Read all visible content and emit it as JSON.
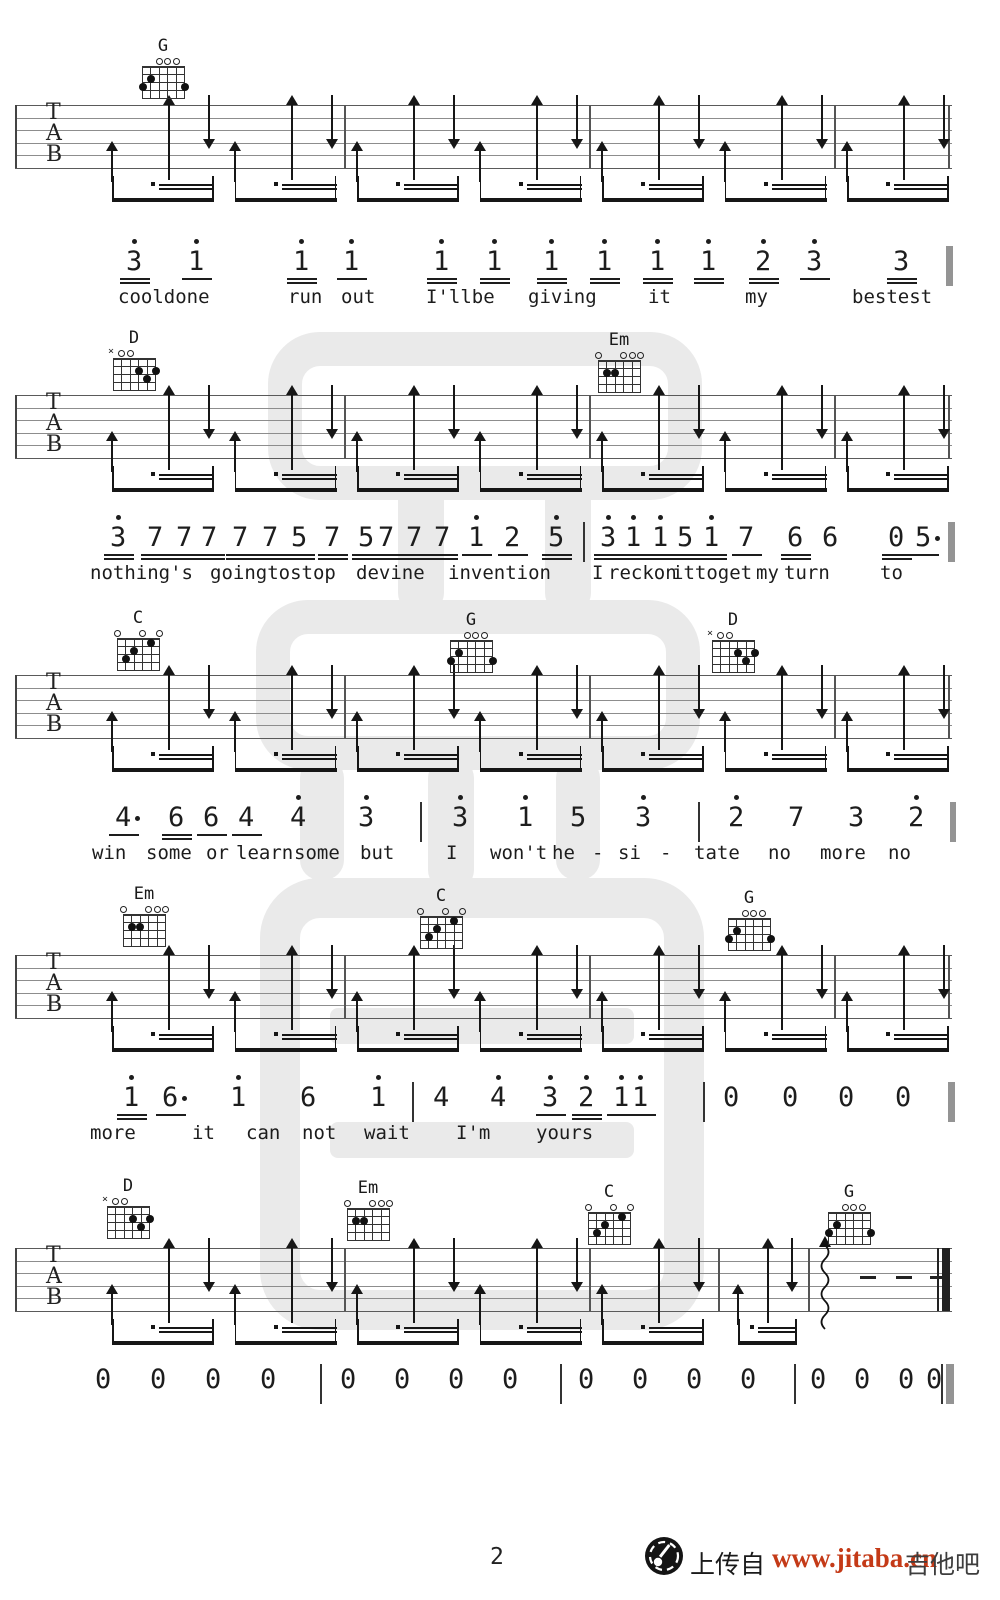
{
  "page": {
    "width": 1000,
    "height": 1600
  },
  "footer": {
    "page_number": "2",
    "upload_label": "上传自",
    "site_url": "www.jitaba.cn",
    "site_name": "吉他吧",
    "url_color": "#c43a17",
    "logo_icon": "guitar-site-logo-icon"
  },
  "ink_color": "#1d1d1d",
  "watermark_color": "#d9d9d9",
  "tab_letters": [
    "T",
    "A",
    "B"
  ],
  "chord_shapes": {
    "G": {
      "markers": [
        "",
        "",
        "o",
        "o",
        "o",
        ""
      ],
      "dots": [
        [
          0,
          3
        ],
        [
          1,
          2
        ],
        [
          5,
          3
        ]
      ]
    },
    "D": {
      "markers": [
        "x",
        "o",
        "o",
        "",
        "",
        ""
      ],
      "dots": [
        [
          3,
          2
        ],
        [
          4,
          3
        ],
        [
          5,
          2
        ]
      ]
    },
    "Em": {
      "markers": [
        "o",
        "",
        "",
        "o",
        "o",
        "o"
      ],
      "dots": [
        [
          1,
          2
        ],
        [
          2,
          2
        ]
      ]
    },
    "C": {
      "markers": [
        "o",
        "",
        "",
        "o",
        "",
        "o"
      ],
      "dots": [
        [
          1,
          3
        ],
        [
          2,
          2
        ],
        [
          4,
          1
        ]
      ]
    }
  },
  "systems": [
    {
      "staffTop": 105,
      "bars": [
        344,
        589,
        834
      ],
      "chords": [
        {
          "name": "G",
          "x": 142,
          "y": 38
        }
      ]
    },
    {
      "staffTop": 395,
      "bars": [
        344,
        589,
        834
      ],
      "chords": [
        {
          "name": "D",
          "x": 113,
          "y": 330
        },
        {
          "name": "Em",
          "x": 598,
          "y": 332
        }
      ]
    },
    {
      "staffTop": 675,
      "bars": [
        344,
        589,
        834
      ],
      "chords": [
        {
          "name": "C",
          "x": 117,
          "y": 610
        },
        {
          "name": "G",
          "x": 450,
          "y": 612
        },
        {
          "name": "D",
          "x": 712,
          "y": 612
        }
      ]
    },
    {
      "staffTop": 955,
      "bars": [
        344,
        589,
        834
      ],
      "chords": [
        {
          "name": "Em",
          "x": 123,
          "y": 886
        },
        {
          "name": "C",
          "x": 420,
          "y": 888
        },
        {
          "name": "G",
          "x": 728,
          "y": 890
        }
      ]
    },
    {
      "staffTop": 1248,
      "bars": [
        344,
        589,
        718
      ],
      "final": true,
      "chords": [
        {
          "name": "D",
          "x": 107,
          "y": 1178
        },
        {
          "name": "Em",
          "x": 347,
          "y": 1180
        },
        {
          "name": "C",
          "x": 588,
          "y": 1184
        },
        {
          "name": "G",
          "x": 828,
          "y": 1184
        }
      ]
    }
  ],
  "number_lines": [
    {
      "y": 248,
      "lyrics_y": 288,
      "tokens": [
        {
          "t": "3",
          "x": 126,
          "h": 1,
          "u": 2
        },
        {
          "t": "1",
          "x": 188,
          "h": 1,
          "u": 1
        },
        {
          "t": "1",
          "x": 293,
          "h": 1,
          "u": 2
        },
        {
          "t": "1",
          "x": 343,
          "h": 1,
          "u": 1
        },
        {
          "t": "1",
          "x": 433,
          "h": 1,
          "u": 2
        },
        {
          "t": "1",
          "x": 486,
          "h": 1,
          "u": 2
        },
        {
          "t": "1",
          "x": 543,
          "h": 1,
          "u": 2
        },
        {
          "t": "1",
          "x": 596,
          "h": 1,
          "u": 2
        },
        {
          "t": "1",
          "x": 649,
          "h": 1,
          "u": 2
        },
        {
          "t": "1",
          "x": 700,
          "h": 1,
          "u": 2
        },
        {
          "t": "2",
          "x": 755,
          "h": 1,
          "u": 2
        },
        {
          "t": "3",
          "x": 806,
          "h": 1,
          "u": 1
        },
        {
          "t": "3",
          "x": 893,
          "u": 2
        },
        {
          "bar": 1,
          "x": 946,
          "w": 7
        }
      ],
      "lyrics": [
        {
          "w": "cooldone",
          "x": 118
        },
        {
          "w": "run",
          "x": 288
        },
        {
          "w": "out",
          "x": 341
        },
        {
          "w": "I'llbe",
          "x": 426
        },
        {
          "w": "giving",
          "x": 528
        },
        {
          "w": "it",
          "x": 648
        },
        {
          "w": "my",
          "x": 745
        },
        {
          "w": "bestest",
          "x": 852
        }
      ]
    },
    {
      "y": 524,
      "lyrics_y": 564,
      "tokens": [
        {
          "t": "3",
          "x": 110,
          "h": 1,
          "u": 2
        },
        {
          "t": "7",
          "x": 147,
          "u": 2
        },
        {
          "t": "7",
          "x": 176,
          "u": 2
        },
        {
          "t": "7",
          "x": 201,
          "u": 2
        },
        {
          "t": "7",
          "x": 232,
          "u": 2
        },
        {
          "t": "7",
          "x": 262,
          "u": 2
        },
        {
          "t": "5",
          "x": 291,
          "u": 2
        },
        {
          "t": "7",
          "x": 324,
          "u": 2
        },
        {
          "t": "5",
          "x": 358,
          "u": 2
        },
        {
          "t": "7",
          "x": 378,
          "u": 2
        },
        {
          "t": "7",
          "x": 406,
          "u": 2
        },
        {
          "t": "7",
          "x": 434,
          "u": 2
        },
        {
          "t": "1",
          "x": 468,
          "h": 1,
          "u": 1
        },
        {
          "t": "2",
          "x": 504,
          "u": 1
        },
        {
          "t": "5",
          "x": 548,
          "h": 1,
          "u": 2
        },
        {
          "bar": 1,
          "x": 583
        },
        {
          "t": "3",
          "x": 600,
          "h": 1,
          "u": 2
        },
        {
          "t": "1",
          "x": 625,
          "h": 1,
          "u": 2
        },
        {
          "t": "1",
          "x": 652,
          "h": 1,
          "u": 2
        },
        {
          "t": "5",
          "x": 677,
          "u": 2
        },
        {
          "t": "1",
          "x": 703,
          "h": 1,
          "u": 2
        },
        {
          "t": "7",
          "x": 738,
          "u": 1
        },
        {
          "t": "6",
          "x": 787,
          "u": 2
        },
        {
          "t": "6",
          "x": 822
        },
        {
          "t": "0",
          "x": 888,
          "u": 2
        },
        {
          "t": "5",
          "x": 915,
          "da": 1,
          "u": 1
        },
        {
          "bar": 1,
          "x": 948,
          "w": 7
        }
      ],
      "lyrics": [
        {
          "w": "nothing's",
          "x": 90
        },
        {
          "w": "goingtostop",
          "x": 210
        },
        {
          "w": "devine",
          "x": 356
        },
        {
          "w": "invention",
          "x": 448
        },
        {
          "w": "I",
          "x": 592
        },
        {
          "w": "reckon",
          "x": 608
        },
        {
          "w": "ittoget",
          "x": 672
        },
        {
          "w": "my",
          "x": 756
        },
        {
          "w": "turn",
          "x": 784
        },
        {
          "w": "to",
          "x": 880
        }
      ]
    },
    {
      "y": 804,
      "lyrics_y": 844,
      "tokens": [
        {
          "t": "4",
          "x": 115,
          "da": 1,
          "u": 1
        },
        {
          "t": "6",
          "x": 168,
          "u": 2
        },
        {
          "t": "6",
          "x": 203,
          "u": 1
        },
        {
          "t": "4",
          "x": 238,
          "u": 1
        },
        {
          "t": "4",
          "x": 290,
          "h": 1
        },
        {
          "t": "3",
          "x": 358,
          "h": 1
        },
        {
          "bar": 1,
          "x": 420
        },
        {
          "t": "3",
          "x": 452,
          "h": 1
        },
        {
          "t": "1",
          "x": 517,
          "h": 1
        },
        {
          "t": "5",
          "x": 570
        },
        {
          "t": "3",
          "x": 635,
          "h": 1
        },
        {
          "bar": 1,
          "x": 698
        },
        {
          "t": "2",
          "x": 728,
          "h": 1
        },
        {
          "t": "7",
          "x": 788
        },
        {
          "t": "3",
          "x": 848
        },
        {
          "t": "2",
          "x": 908,
          "h": 1
        },
        {
          "bar": 1,
          "x": 950,
          "w": 6
        }
      ],
      "lyrics": [
        {
          "w": "win",
          "x": 92
        },
        {
          "w": "some",
          "x": 146
        },
        {
          "w": "or",
          "x": 206
        },
        {
          "w": "learn",
          "x": 236
        },
        {
          "w": "some",
          "x": 294
        },
        {
          "w": "but",
          "x": 360
        },
        {
          "w": "I",
          "x": 446
        },
        {
          "w": "won't",
          "x": 490
        },
        {
          "w": "he",
          "x": 552
        },
        {
          "w": "-",
          "x": 592
        },
        {
          "w": "si",
          "x": 618
        },
        {
          "w": "-",
          "x": 660
        },
        {
          "w": "tate",
          "x": 694
        },
        {
          "w": "no",
          "x": 768
        },
        {
          "w": "more",
          "x": 820
        },
        {
          "w": "no",
          "x": 888
        }
      ]
    },
    {
      "y": 1084,
      "lyrics_y": 1124,
      "tokens": [
        {
          "t": "1",
          "x": 123,
          "h": 1,
          "u": 2
        },
        {
          "t": "6",
          "x": 162,
          "da": 1,
          "u": 1
        },
        {
          "t": "1",
          "x": 230,
          "h": 1
        },
        {
          "t": "6",
          "x": 300
        },
        {
          "t": "1",
          "x": 370,
          "h": 1
        },
        {
          "bar": 1,
          "x": 412
        },
        {
          "t": "4",
          "x": 433
        },
        {
          "t": "4",
          "x": 490,
          "h": 1
        },
        {
          "t": "3",
          "x": 542,
          "h": 1,
          "u": 1
        },
        {
          "t": "2",
          "x": 578,
          "h": 1,
          "u": 2
        },
        {
          "t": "1",
          "x": 613,
          "h": 1,
          "u": 1
        },
        {
          "t": "1",
          "x": 632,
          "h": 1,
          "u": 1
        },
        {
          "bar": 1,
          "x": 703
        },
        {
          "t": "0",
          "x": 723
        },
        {
          "t": "0",
          "x": 782
        },
        {
          "t": "0",
          "x": 838
        },
        {
          "t": "0",
          "x": 895
        },
        {
          "bar": 1,
          "x": 948,
          "w": 7
        }
      ],
      "lyrics": [
        {
          "w": "more",
          "x": 90
        },
        {
          "w": "it",
          "x": 192
        },
        {
          "w": "can",
          "x": 246
        },
        {
          "w": "not",
          "x": 302
        },
        {
          "w": "wait",
          "x": 364
        },
        {
          "w": "I'm",
          "x": 456
        },
        {
          "w": "yours",
          "x": 536
        }
      ]
    },
    {
      "y": 1366,
      "lyrics_y": 1410,
      "tokens": [
        {
          "t": "0",
          "x": 95
        },
        {
          "t": "0",
          "x": 150
        },
        {
          "t": "0",
          "x": 205
        },
        {
          "t": "0",
          "x": 260
        },
        {
          "bar": 1,
          "x": 320
        },
        {
          "t": "0",
          "x": 340
        },
        {
          "t": "0",
          "x": 394
        },
        {
          "t": "0",
          "x": 448
        },
        {
          "t": "0",
          "x": 502
        },
        {
          "bar": 1,
          "x": 560
        },
        {
          "t": "0",
          "x": 578
        },
        {
          "t": "0",
          "x": 632
        },
        {
          "t": "0",
          "x": 686
        },
        {
          "t": "0",
          "x": 740
        },
        {
          "bar": 1,
          "x": 794
        },
        {
          "t": "0",
          "x": 810
        },
        {
          "t": "0",
          "x": 854
        },
        {
          "t": "0",
          "x": 898
        },
        {
          "t": "0",
          "x": 926
        },
        {
          "bar": 1,
          "x": 941,
          "w": 2
        },
        {
          "bar": 1,
          "x": 946,
          "w": 8
        }
      ],
      "lyrics": []
    }
  ]
}
